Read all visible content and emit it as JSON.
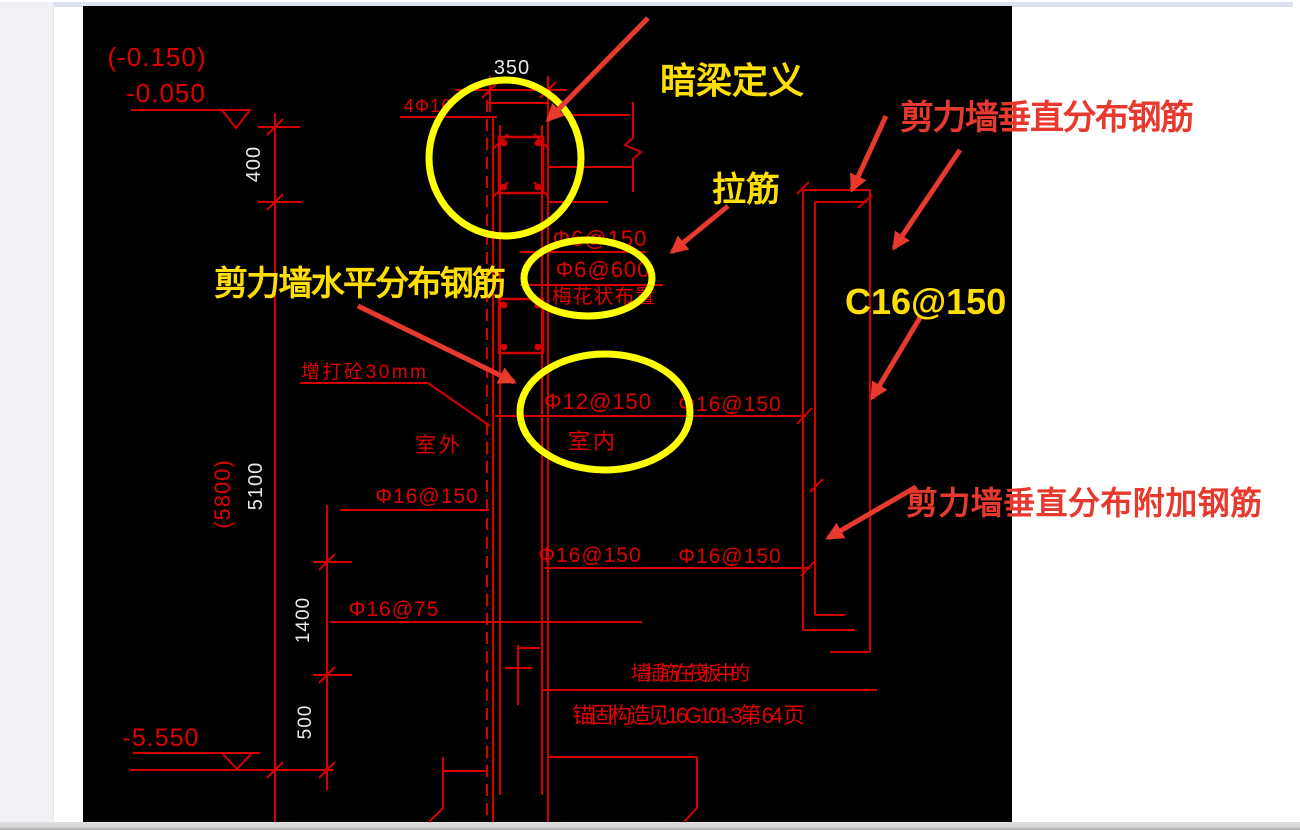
{
  "window": {
    "left_panel": "side-panel",
    "top_strip": "panel-top-edge",
    "status_bar": "horizontal-scrollbar"
  },
  "cad": {
    "levels": {
      "top_bracket": "(-0.150)",
      "top": "-0.050",
      "bottom": "-5.550"
    },
    "dimensions": {
      "width_350": "350",
      "h_400": "400",
      "h_5100": "5100",
      "h_5800": "(5800)",
      "h_1400": "1400",
      "h_500": "500"
    },
    "labels": {
      "beam_bars": "4Φ16",
      "tie_150": "Φ6@150",
      "tie_600": "Φ6@600",
      "tie_note": "梅花状布置",
      "wall_horizontal": "Φ12@150",
      "indoor": "室内",
      "outdoor": "室外",
      "concrete_note": "增打砼30mm",
      "vert_left": "Φ16@150",
      "vert_left_low": "Φ16@75",
      "vert_mid": "Φ16@150",
      "vert_right_top": "Φ16@150",
      "vert_right": "Φ16@150",
      "anchor_line1": "墙插筋在筏板中的",
      "anchor_line2": "锚固构造见16G101-3第 64 页"
    }
  },
  "annotations": {
    "dark_beam": "暗梁定义",
    "tie": "拉筋",
    "horizontal_rebar": "剪力墙水平分布钢筋",
    "vertical_rebar": "剪力墙垂直分布钢筋",
    "rebar_spec": "C16@150",
    "additional_rebar": "剪力墙垂直分布附加钢筋"
  },
  "colors": {
    "cad_line_red": "#d40000",
    "cad_text_red": "#e00000",
    "dim_white": "#e9e9e9",
    "highlight_yellow": "#ffff00",
    "annotation_yellow": "#ffdf00",
    "annotation_red": "#e8392e",
    "canvas_black": "#000000",
    "panel_gray": "#f0f1f4",
    "strip_blue": "#dce3ee"
  }
}
